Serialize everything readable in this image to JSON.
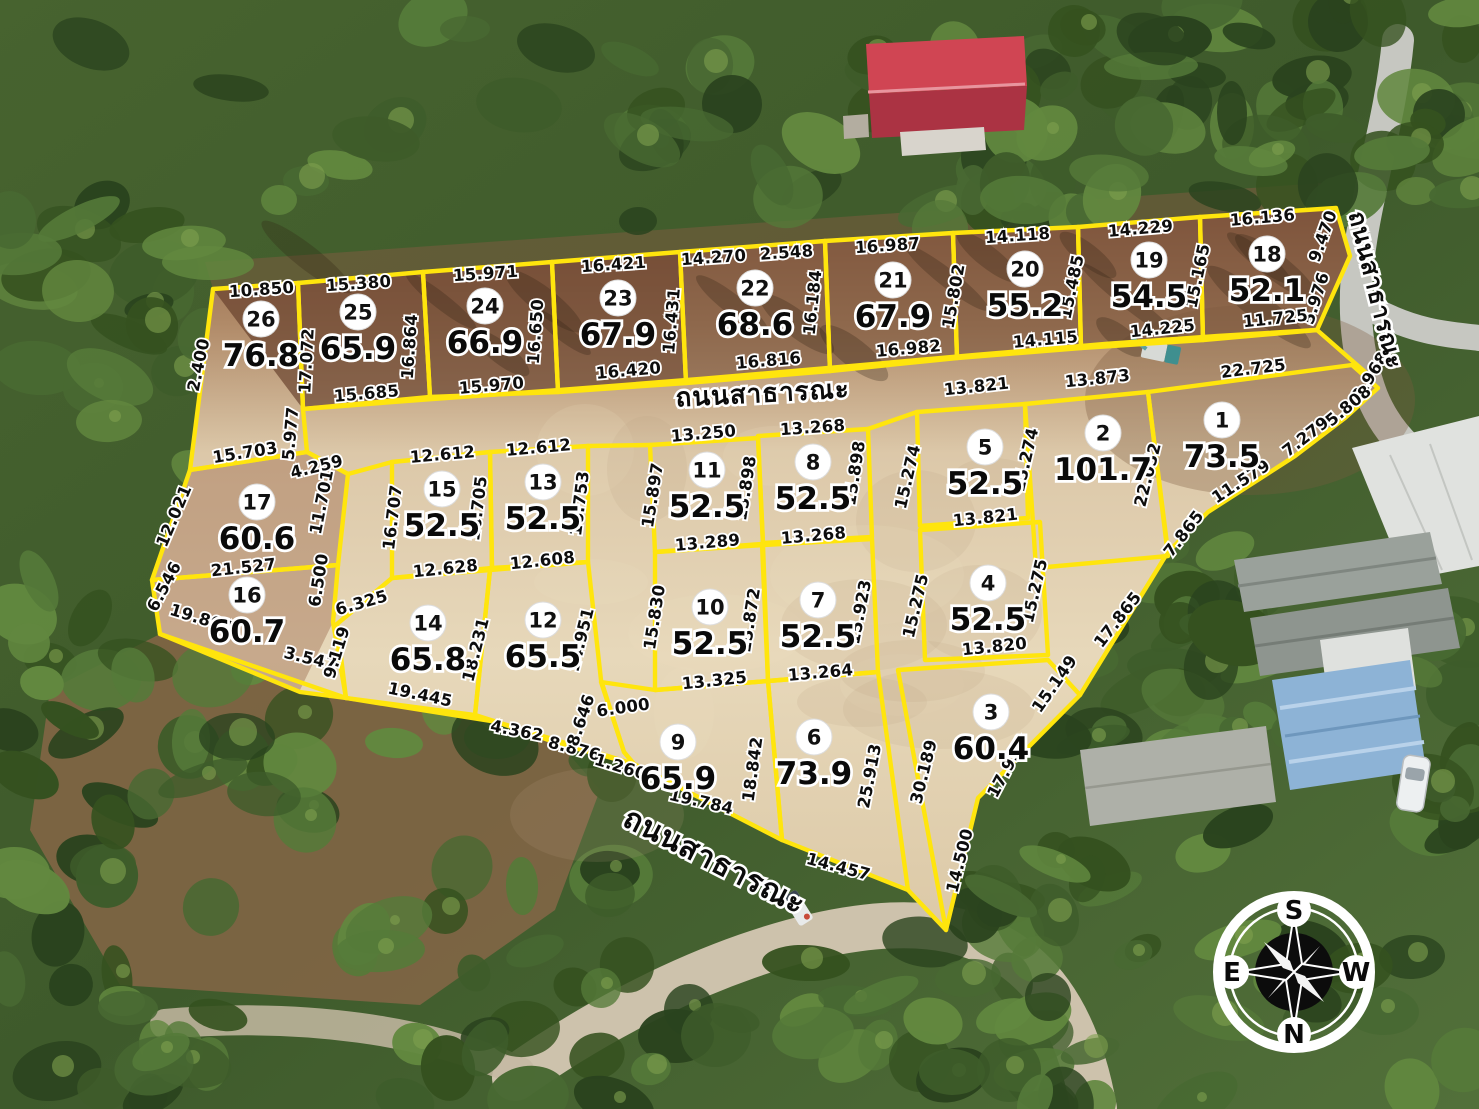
{
  "map": {
    "title": "land-subdivision-aerial-plat",
    "road_label": "ถนนสาธารณะ",
    "boundary_color": "#ffe50d",
    "compass": {
      "top": "S",
      "bottom": "N",
      "left": "E",
      "right": "W"
    },
    "road_labels": [
      {
        "text": "ถนนสาธารณะ",
        "x": 763,
        "y": 402,
        "r": -3,
        "size": 26
      },
      {
        "text": "ถนนสาธารณะ",
        "x": 1368,
        "y": 292,
        "r": 76,
        "size": 24
      },
      {
        "text": "ถนนสาธารณะ",
        "x": 710,
        "y": 870,
        "r": 27,
        "size": 30
      }
    ],
    "plots": [
      {
        "no": "1",
        "area": "73.5",
        "x": 1222,
        "y": 420
      },
      {
        "no": "2",
        "area": "101.7",
        "x": 1103,
        "y": 433
      },
      {
        "no": "3",
        "area": "60.4",
        "x": 991,
        "y": 712
      },
      {
        "no": "4",
        "area": "52.5",
        "x": 988,
        "y": 583
      },
      {
        "no": "5",
        "area": "52.5",
        "x": 985,
        "y": 447
      },
      {
        "no": "6",
        "area": "73.9",
        "x": 814,
        "y": 737
      },
      {
        "no": "7",
        "area": "52.5",
        "x": 818,
        "y": 600
      },
      {
        "no": "8",
        "area": "52.5",
        "x": 813,
        "y": 462
      },
      {
        "no": "9",
        "area": "65.9",
        "x": 678,
        "y": 742
      },
      {
        "no": "10",
        "area": "52.5",
        "x": 710,
        "y": 607
      },
      {
        "no": "11",
        "area": "52.5",
        "x": 707,
        "y": 470
      },
      {
        "no": "12",
        "area": "65.5",
        "x": 543,
        "y": 620
      },
      {
        "no": "13",
        "area": "52.5",
        "x": 543,
        "y": 482
      },
      {
        "no": "14",
        "area": "65.8",
        "x": 428,
        "y": 623
      },
      {
        "no": "15",
        "area": "52.5",
        "x": 442,
        "y": 489
      },
      {
        "no": "16",
        "area": "60.7",
        "x": 247,
        "y": 595
      },
      {
        "no": "17",
        "area": "60.6",
        "x": 257,
        "y": 502
      },
      {
        "no": "18",
        "area": "52.1",
        "x": 1267,
        "y": 254
      },
      {
        "no": "19",
        "area": "54.5",
        "x": 1149,
        "y": 260
      },
      {
        "no": "20",
        "area": "55.2",
        "x": 1025,
        "y": 269
      },
      {
        "no": "21",
        "area": "67.9",
        "x": 893,
        "y": 280
      },
      {
        "no": "22",
        "area": "68.6",
        "x": 755,
        "y": 288
      },
      {
        "no": "23",
        "area": "67.9",
        "x": 618,
        "y": 298
      },
      {
        "no": "24",
        "area": "66.9",
        "x": 485,
        "y": 306
      },
      {
        "no": "25",
        "area": "65.9",
        "x": 358,
        "y": 312
      },
      {
        "no": "26",
        "area": "76.8",
        "x": 261,
        "y": 319
      }
    ],
    "dimensions": [
      {
        "t": "10.850",
        "x": 262,
        "y": 295,
        "r": -4
      },
      {
        "t": "2.400",
        "x": 204,
        "y": 366,
        "r": -78
      },
      {
        "t": "15.703",
        "x": 246,
        "y": 458,
        "r": -9
      },
      {
        "t": "5.977",
        "x": 296,
        "y": 434,
        "r": -85
      },
      {
        "t": "4.259",
        "x": 318,
        "y": 472,
        "r": -14
      },
      {
        "t": "15.380",
        "x": 359,
        "y": 289,
        "r": -4
      },
      {
        "t": "17.072",
        "x": 312,
        "y": 361,
        "r": -87
      },
      {
        "t": "16.864",
        "x": 415,
        "y": 347,
        "r": -86
      },
      {
        "t": "15.685",
        "x": 367,
        "y": 399,
        "r": -5
      },
      {
        "t": "15.971",
        "x": 486,
        "y": 279,
        "r": -4
      },
      {
        "t": "16.650",
        "x": 541,
        "y": 332,
        "r": -86
      },
      {
        "t": "15.970",
        "x": 492,
        "y": 391,
        "r": -5
      },
      {
        "t": "16.421",
        "x": 614,
        "y": 270,
        "r": -4
      },
      {
        "t": "16.431",
        "x": 677,
        "y": 321,
        "r": -85
      },
      {
        "t": "16.420",
        "x": 629,
        "y": 376,
        "r": -5
      },
      {
        "t": "14.270",
        "x": 714,
        "y": 263,
        "r": -4
      },
      {
        "t": "2.548",
        "x": 787,
        "y": 258,
        "r": -4
      },
      {
        "t": "16.184",
        "x": 818,
        "y": 303,
        "r": -84
      },
      {
        "t": "16.816",
        "x": 769,
        "y": 366,
        "r": -5
      },
      {
        "t": "16.987",
        "x": 888,
        "y": 251,
        "r": -4
      },
      {
        "t": "15.802",
        "x": 959,
        "y": 297,
        "r": -80
      },
      {
        "t": "16.982",
        "x": 909,
        "y": 354,
        "r": -5
      },
      {
        "t": "14.118",
        "x": 1018,
        "y": 241,
        "r": -4
      },
      {
        "t": "15.485",
        "x": 1077,
        "y": 288,
        "r": -78
      },
      {
        "t": "14.115",
        "x": 1046,
        "y": 345,
        "r": -5
      },
      {
        "t": "14.229",
        "x": 1141,
        "y": 234,
        "r": -5
      },
      {
        "t": "15.165",
        "x": 1203,
        "y": 277,
        "r": -78
      },
      {
        "t": "14.225",
        "x": 1163,
        "y": 334,
        "r": -6
      },
      {
        "t": "16.136",
        "x": 1263,
        "y": 223,
        "r": -5
      },
      {
        "t": "9.470",
        "x": 1328,
        "y": 238,
        "r": -70
      },
      {
        "t": "5.976",
        "x": 1321,
        "y": 300,
        "r": -72
      },
      {
        "t": "11.725",
        "x": 1276,
        "y": 324,
        "r": -6
      },
      {
        "t": "22.725",
        "x": 1254,
        "y": 374,
        "r": -7
      },
      {
        "t": "3.968",
        "x": 1375,
        "y": 379,
        "r": -58
      },
      {
        "t": "13.873",
        "x": 1098,
        "y": 384,
        "r": -6
      },
      {
        "t": "13.821",
        "x": 977,
        "y": 392,
        "r": -6
      },
      {
        "t": "13.250",
        "x": 704,
        "y": 439,
        "r": -5
      },
      {
        "t": "13.268",
        "x": 813,
        "y": 433,
        "r": -4
      },
      {
        "t": "15.897",
        "x": 658,
        "y": 496,
        "r": -81
      },
      {
        "t": "15.898",
        "x": 751,
        "y": 489,
        "r": -81
      },
      {
        "t": "15.898",
        "x": 860,
        "y": 474,
        "r": -81
      },
      {
        "t": "13.289",
        "x": 708,
        "y": 548,
        "r": -5
      },
      {
        "t": "13.268",
        "x": 814,
        "y": 541,
        "r": -5
      },
      {
        "t": "15.274",
        "x": 913,
        "y": 478,
        "r": -77
      },
      {
        "t": "15.274",
        "x": 1031,
        "y": 461,
        "r": -77
      },
      {
        "t": "13.821",
        "x": 986,
        "y": 523,
        "r": -6
      },
      {
        "t": "22.052",
        "x": 1153,
        "y": 476,
        "r": -76
      },
      {
        "t": "5.808",
        "x": 1352,
        "y": 410,
        "r": -40
      },
      {
        "t": "7.279",
        "x": 1309,
        "y": 441,
        "r": -38
      },
      {
        "t": "11.579",
        "x": 1244,
        "y": 486,
        "r": -33
      },
      {
        "t": "7.865",
        "x": 1188,
        "y": 537,
        "r": -52
      },
      {
        "t": "17.865",
        "x": 1122,
        "y": 623,
        "r": -52
      },
      {
        "t": "15.149",
        "x": 1059,
        "y": 687,
        "r": -55
      },
      {
        "t": "12.612",
        "x": 443,
        "y": 460,
        "r": -5
      },
      {
        "t": "12.612",
        "x": 539,
        "y": 453,
        "r": -5
      },
      {
        "t": "16.707",
        "x": 398,
        "y": 518,
        "r": -83
      },
      {
        "t": "16.705",
        "x": 483,
        "y": 509,
        "r": -83
      },
      {
        "t": "16.753",
        "x": 585,
        "y": 504,
        "r": -83
      },
      {
        "t": "12.628",
        "x": 446,
        "y": 574,
        "r": -6
      },
      {
        "t": "12.608",
        "x": 543,
        "y": 566,
        "r": -6
      },
      {
        "t": "12.021",
        "x": 179,
        "y": 518,
        "r": -67
      },
      {
        "t": "11.701",
        "x": 327,
        "y": 503,
        "r": -79
      },
      {
        "t": "21.527",
        "x": 244,
        "y": 573,
        "r": -6
      },
      {
        "t": "6.546",
        "x": 169,
        "y": 589,
        "r": -62
      },
      {
        "t": "19.804",
        "x": 200,
        "y": 624,
        "r": 17
      },
      {
        "t": "6.500",
        "x": 324,
        "y": 581,
        "r": -81
      },
      {
        "t": "3.547",
        "x": 309,
        "y": 664,
        "r": 14
      },
      {
        "t": "6.325",
        "x": 363,
        "y": 608,
        "r": -16
      },
      {
        "t": "9.119",
        "x": 342,
        "y": 654,
        "r": -73
      },
      {
        "t": "18.231",
        "x": 481,
        "y": 651,
        "r": -76
      },
      {
        "t": "19.445",
        "x": 419,
        "y": 700,
        "r": 12
      },
      {
        "t": "14.951",
        "x": 586,
        "y": 641,
        "r": -76
      },
      {
        "t": "4.362",
        "x": 516,
        "y": 736,
        "r": 11
      },
      {
        "t": "8.876",
        "x": 573,
        "y": 754,
        "r": 15
      },
      {
        "t": "8.646",
        "x": 586,
        "y": 722,
        "r": -71
      },
      {
        "t": "1.260",
        "x": 619,
        "y": 772,
        "r": 17
      },
      {
        "t": "6.000",
        "x": 624,
        "y": 713,
        "r": -8
      },
      {
        "t": "15.830",
        "x": 660,
        "y": 618,
        "r": -81
      },
      {
        "t": "15.872",
        "x": 755,
        "y": 621,
        "r": -81
      },
      {
        "t": "13.325",
        "x": 715,
        "y": 686,
        "r": -6
      },
      {
        "t": "13.264",
        "x": 821,
        "y": 678,
        "r": -5
      },
      {
        "t": "15.923",
        "x": 865,
        "y": 613,
        "r": -79
      },
      {
        "t": "15.275",
        "x": 921,
        "y": 607,
        "r": -77
      },
      {
        "t": "15.275",
        "x": 1040,
        "y": 592,
        "r": -77
      },
      {
        "t": "13.820",
        "x": 995,
        "y": 652,
        "r": -6
      },
      {
        "t": "18.842",
        "x": 758,
        "y": 770,
        "r": -82
      },
      {
        "t": "25.913",
        "x": 875,
        "y": 777,
        "r": -79
      },
      {
        "t": "30.189",
        "x": 929,
        "y": 773,
        "r": -76
      },
      {
        "t": "17.937",
        "x": 1012,
        "y": 770,
        "r": -62
      },
      {
        "t": "14.500",
        "x": 965,
        "y": 862,
        "r": -76
      },
      {
        "t": "19.784",
        "x": 700,
        "y": 807,
        "r": 13
      },
      {
        "t": "14.457",
        "x": 837,
        "y": 872,
        "r": 15
      }
    ]
  }
}
